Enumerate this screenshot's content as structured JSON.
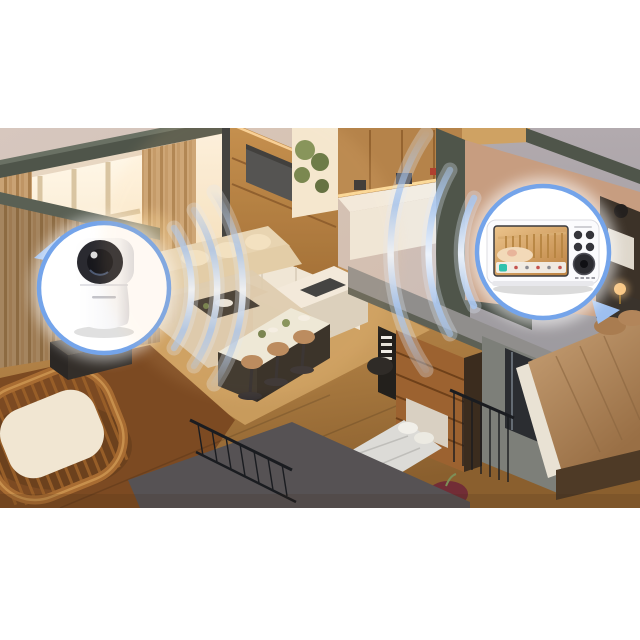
{
  "colors": {
    "bg-pink": "#cdbcb5",
    "bg-pink-light": "#d7c7be",
    "bg-gray": "#a9a1a6",
    "floor-gray": "#85878d",
    "wall-dark": "#4f554a",
    "wall-dark2": "#5a6054",
    "wall-gray": "#908e8c",
    "wood-dark": "#8a5a28",
    "wood-mid": "#b5834a",
    "wood-light": "#cfa263",
    "floor-walnut": "#7c4a22",
    "window-glow": "#fff3dd",
    "curtain-a": "#c9a274",
    "curtain-b": "#a97f4e",
    "sofa": "#e6d5b6",
    "rug": "#dbccb4",
    "counter-white": "#f2ede3",
    "cabinet-white": "#efe9de",
    "tv-dark": "#41464c",
    "badge-ring": "#74a4ea",
    "badge-fill": "#ffffff",
    "wave": "#a9c6ee",
    "wave-soft": "#e2ecfa",
    "camera-lens": "#17171c",
    "monitor-body": "#fbfbfd",
    "screen-warm": "#dcab6e",
    "screen-teal": "#2fc2ae",
    "bed-tan": "#c09a6f",
    "duvet": "#dcdbd7",
    "blanket-green": "#5e6a50",
    "pouf-maroon": "#722d36",
    "table-top": "#edebdf",
    "table-base": "#2f2b27",
    "stool-seat": "#b5855a",
    "railing": "#1a1c20",
    "glass-dark": "#2b2d31"
  },
  "badges": {
    "camera_badge": {
      "icon": "pan-tilt-baby-camera",
      "pointer_icon": "badge-pointer-triangle"
    },
    "monitor_badge": {
      "icon": "parent-monitor-unit",
      "pointer_icon": "badge-pointer-triangle",
      "screen": {
        "view_icon": "crib-with-baby-live-view",
        "toolbar_primary_icon": "menu-tile-icon",
        "toolbar_primary_color": "#2fc2ae",
        "toolbar_dot_colors": [
          "#c4534e",
          "#8a8a90",
          "#c4534e",
          "#8a8a90",
          "#c4534e"
        ]
      },
      "controls": {
        "round_buttons": 4,
        "dpad_icon": "directional-pad-icon"
      }
    }
  },
  "waves": {
    "icon": "wifi-ripple-waves",
    "left_count": 3,
    "right_count": 3,
    "color": "#a9c6ee"
  }
}
